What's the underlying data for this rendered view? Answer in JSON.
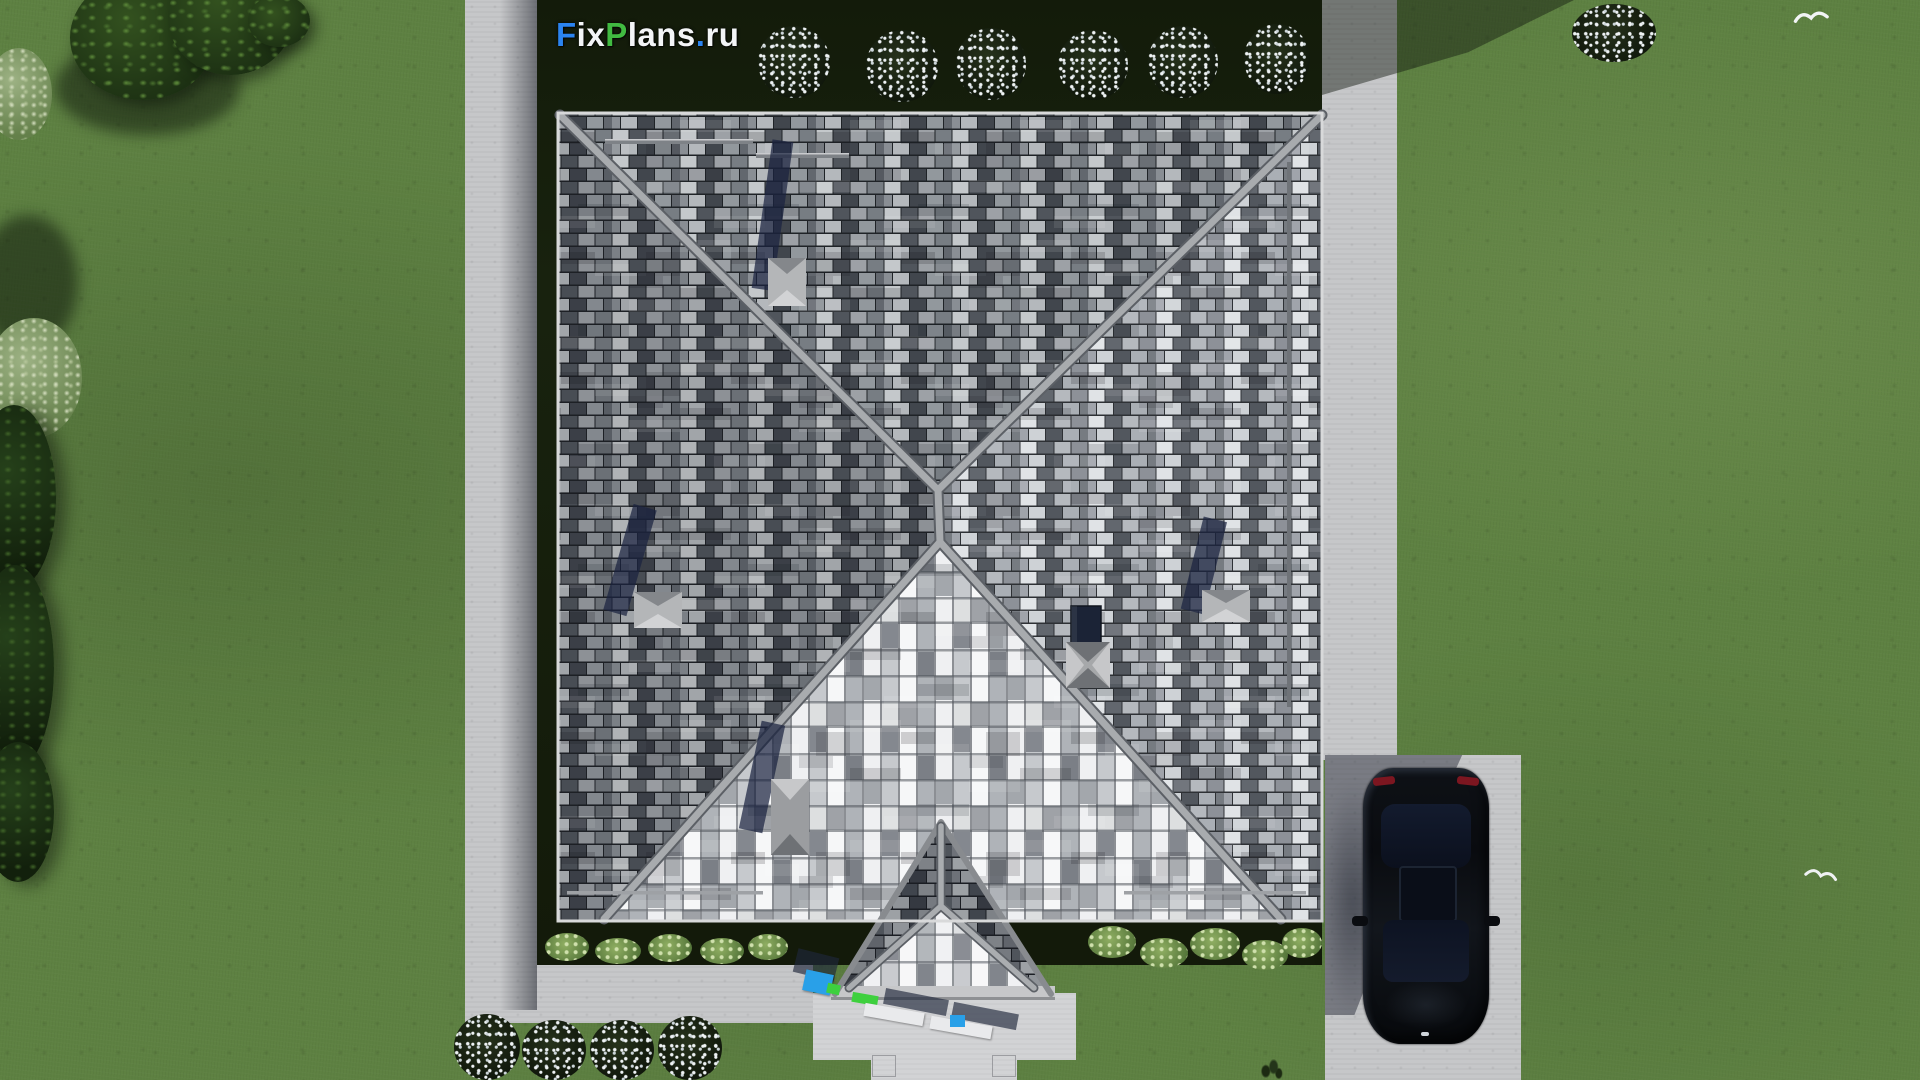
{
  "watermark": {
    "text": "FixPlans.ru",
    "segments": [
      {
        "text": "F",
        "color": "#2b84f0"
      },
      {
        "text": "ix",
        "color": "#f3f5f7"
      },
      {
        "text": "P",
        "color": "#41ba41"
      },
      {
        "text": "lans",
        "color": "#f3f5f7"
      },
      {
        "text": ".",
        "color": "#2b84f0"
      },
      {
        "text": "ru",
        "color": "#f3f5f7"
      }
    ]
  },
  "palette": {
    "grass": "#5e8142",
    "hedge": "#18220e",
    "path": "#c6c7c9",
    "path_light": "#d2d3d5",
    "ridge": "#a8abae",
    "skylight_glass": "#1f2a4a",
    "car_body": "#0b0e13",
    "taillight_red": "#7c1620",
    "flower_white": "#eef2f4",
    "item_blue": "#29a0e8",
    "item_green": "#3ed03e"
  }
}
